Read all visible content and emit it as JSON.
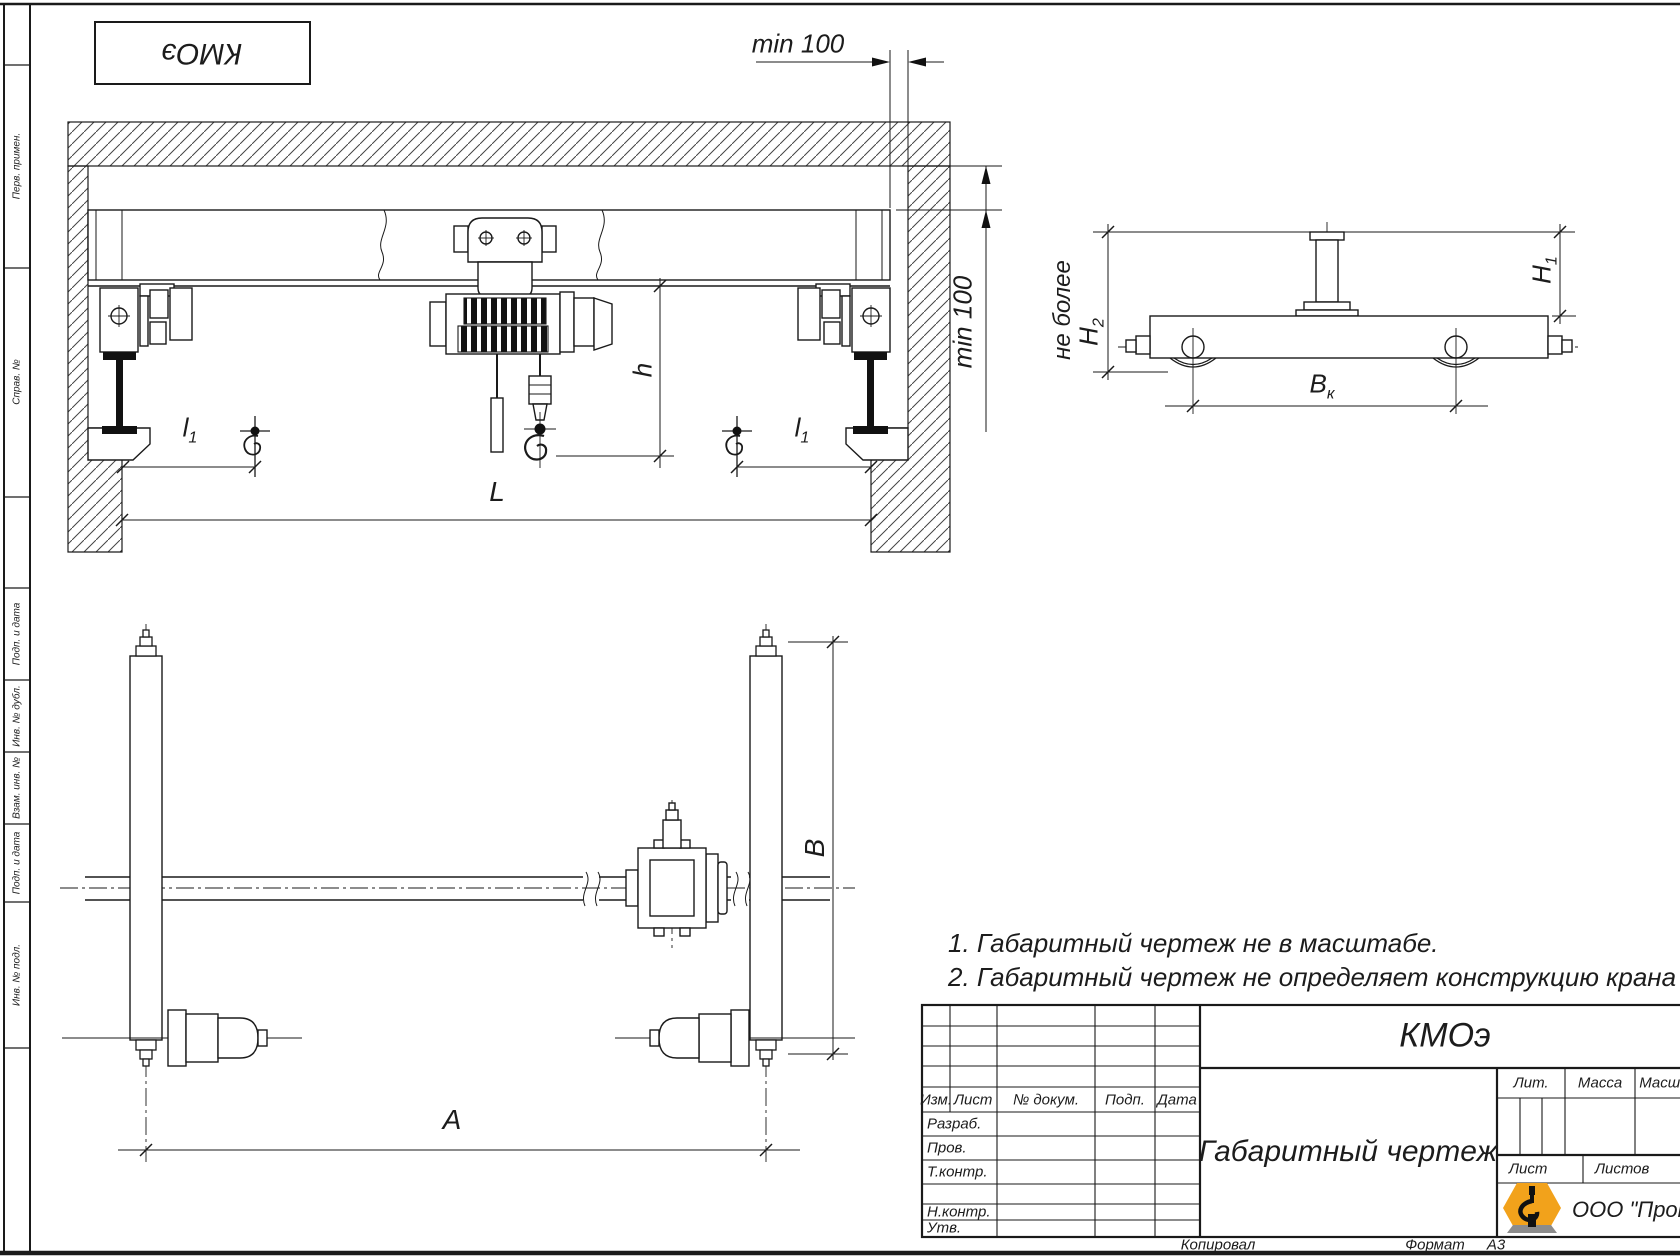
{
  "stamp": {
    "designation": "КМОэ"
  },
  "dims": {
    "min100_top": "min 100",
    "min100_gap": "min 100",
    "ne_bolee": "не более",
    "h2": {
      "main": "H",
      "sub": "2"
    },
    "h1": {
      "main": "H",
      "sub": "1"
    },
    "bk": {
      "main": "B",
      "sub": "к"
    },
    "h": "h",
    "l1_left": {
      "main": "l",
      "sub": "1"
    },
    "l1_right": {
      "main": "l",
      "sub": "1"
    },
    "L": "L",
    "B": "B",
    "A": "A"
  },
  "notes": {
    "line1": "1. Габаритный чертеж не в масштабе.",
    "line2": "2. Габаритный чертеж не определяет конструкцию крана"
  },
  "title_block": {
    "designation": "КМОэ",
    "doc_title": "Габаритный чертеж",
    "columns": {
      "izm": "Изм.",
      "list": "Лист",
      "docnum": "№ докум.",
      "podp": "Подп.",
      "data": "Дата"
    },
    "rows": {
      "razrab": "Разраб.",
      "prov": "Пров.",
      "tkontr": "Т.контр.",
      "nkontr": "Н.контр.",
      "utv": "Утв."
    },
    "lit": "Лит.",
    "massa": "Масса",
    "masshtab": "Масшт.",
    "list_label": "Лист",
    "listov_label": "Листов",
    "company": "ООО \"ПромМа"
  },
  "footer": {
    "kopiroval": "Копировал",
    "format_label": "Формат",
    "format_value": "А3"
  },
  "frame": {
    "labels": [
      "Перв. примен.",
      "Справ. №",
      "Подп. и дата",
      "Инв. № дубл.",
      "Взам. инв. №",
      "Подп. и дата",
      "Инв. № подл."
    ]
  },
  "logo": {
    "accent": "#F2A21B",
    "base": "#8C8C8C",
    "ink": "#111111"
  }
}
